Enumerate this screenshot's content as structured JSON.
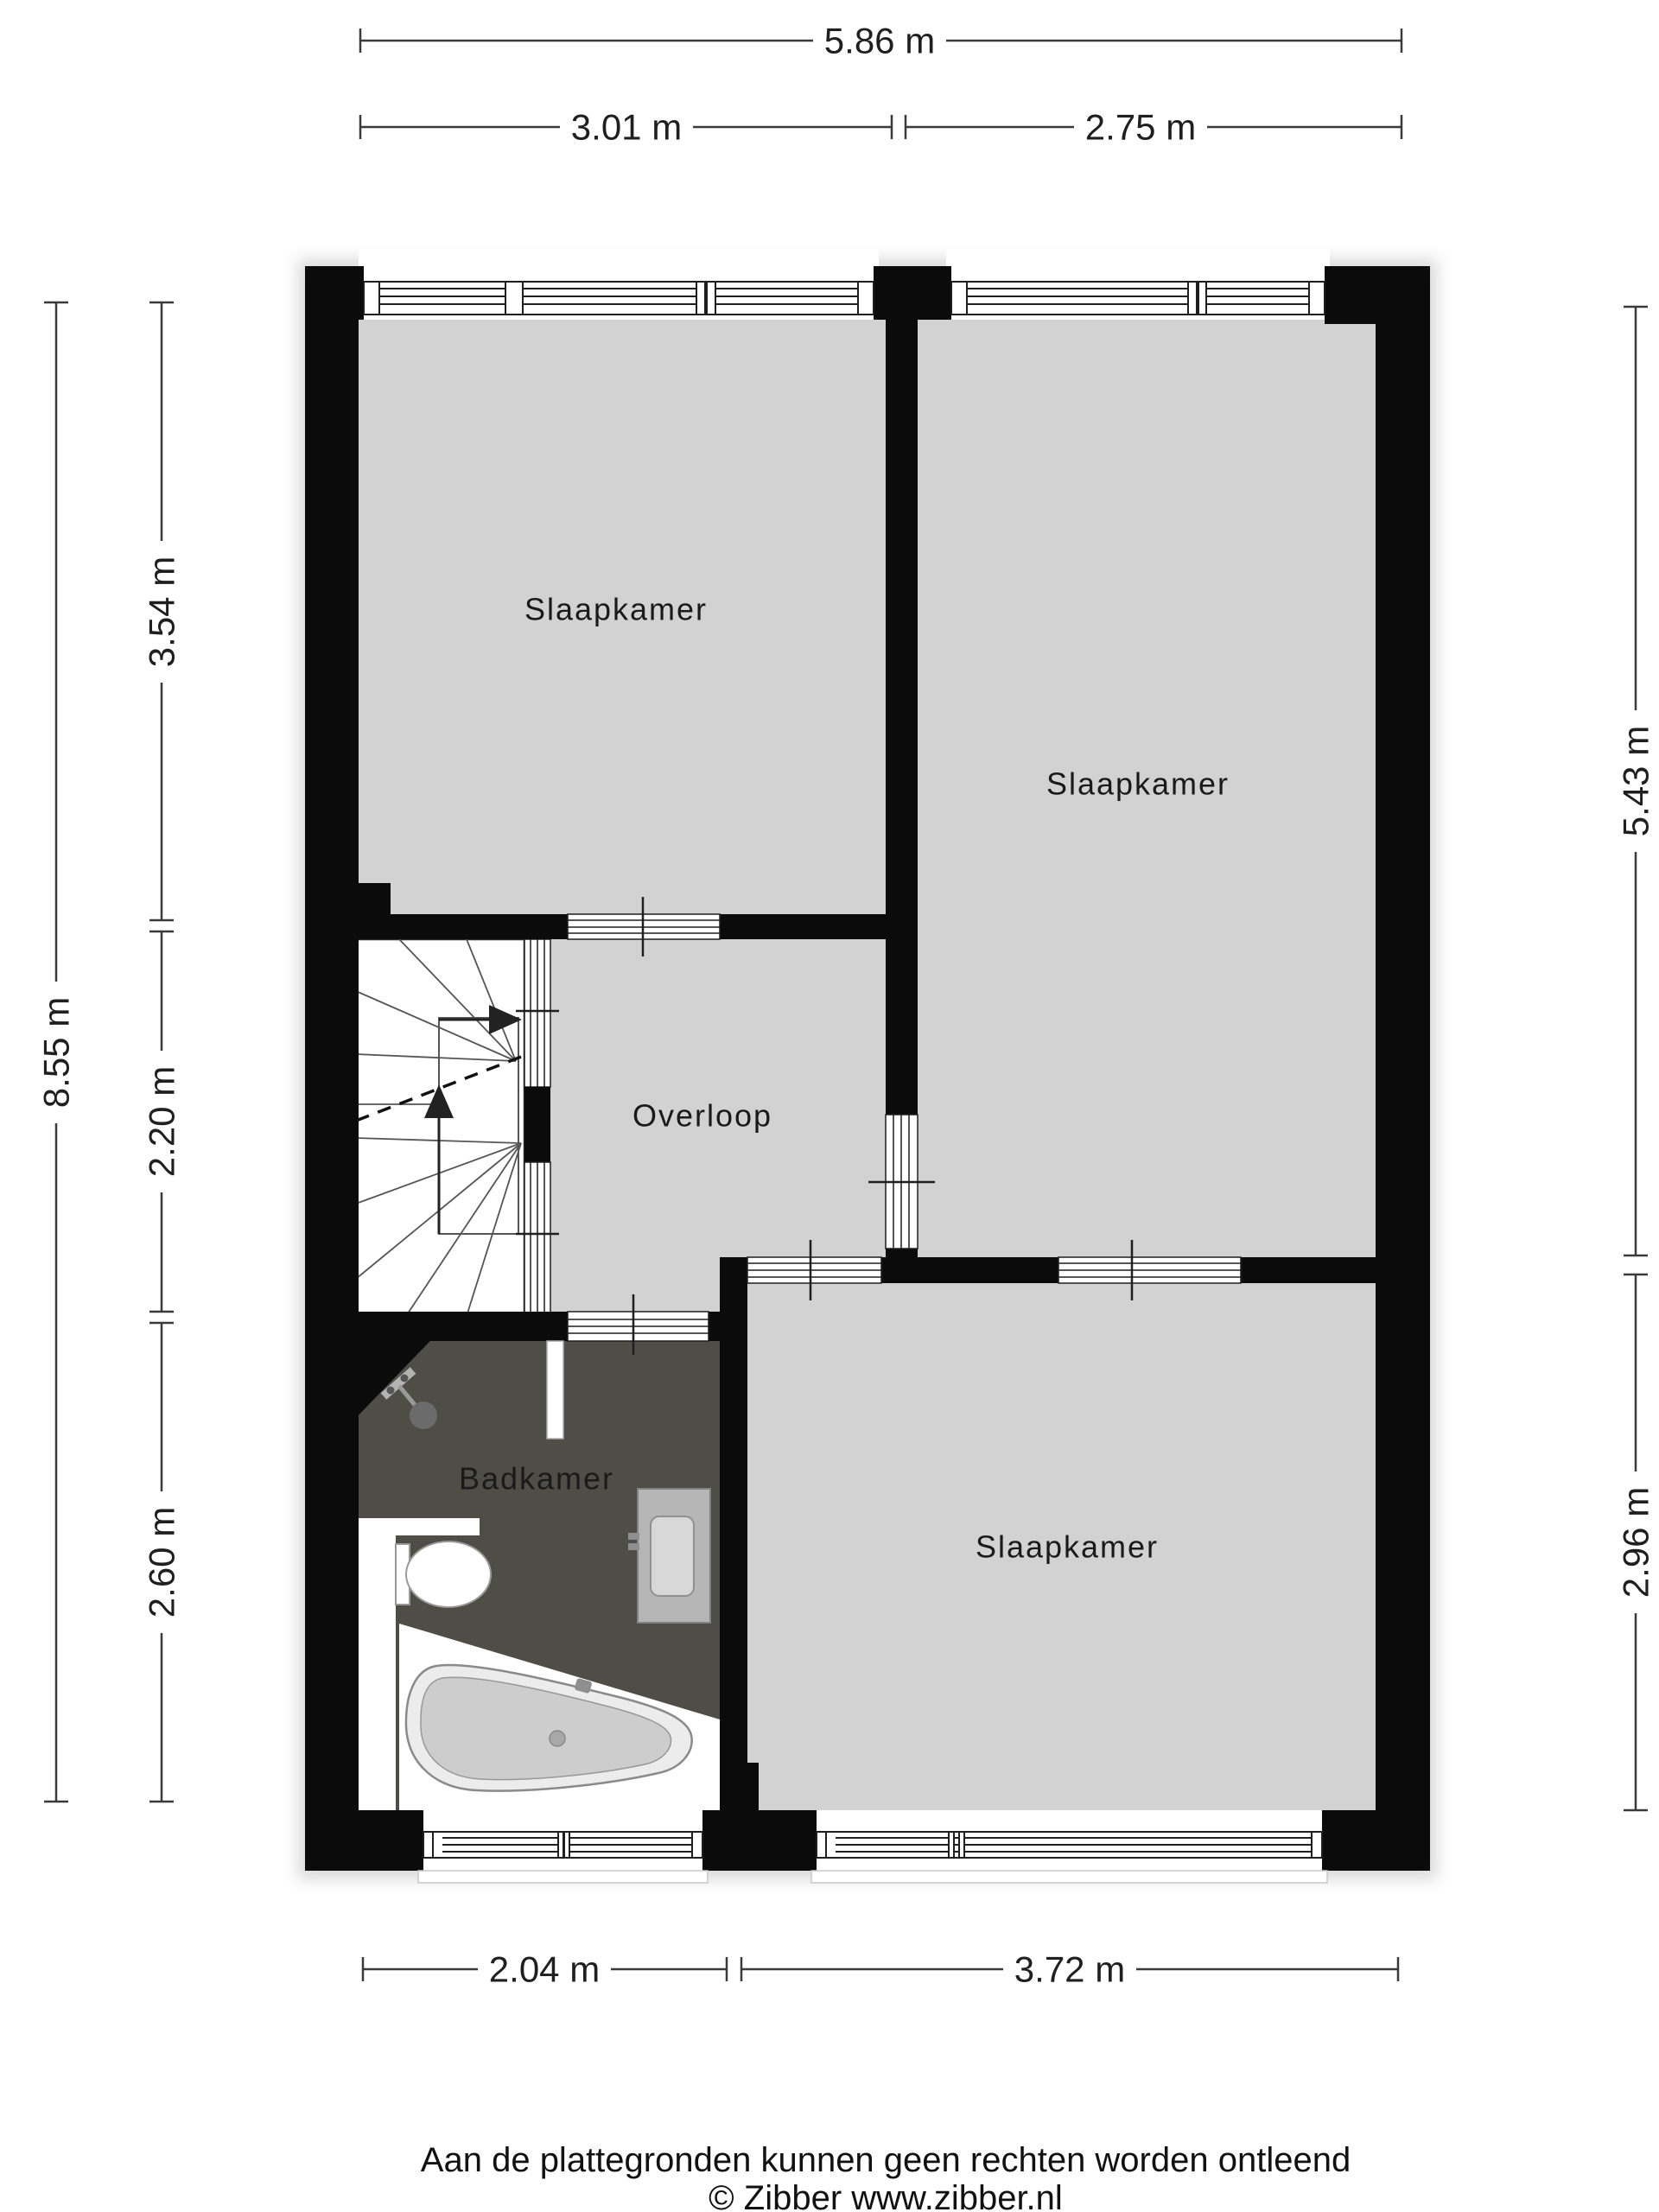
{
  "colors": {
    "wall": "#0b0b0b",
    "floor": "#d2d2d2",
    "bathroom_floor": "#4e4e47",
    "fixture_gray": "#b6b6b6"
  },
  "rooms": {
    "slaapkamer_top_left": "Slaapkamer",
    "slaapkamer_top_right": "Slaapkamer",
    "slaapkamer_bottom": "Slaapkamer",
    "overloop": "Overloop",
    "badkamer": "Badkamer"
  },
  "dimensions": {
    "top_total": "5.86 m",
    "top_left": "3.01 m",
    "top_right": "2.75 m",
    "left_total": "8.55 m",
    "left_upper": "3.54 m",
    "left_middle": "2.20 m",
    "left_lower": "2.60 m",
    "right_upper": "5.43 m",
    "right_lower": "2.96 m",
    "bottom_left": "2.04 m",
    "bottom_right": "3.72 m"
  },
  "footer": {
    "disclaimer": "Aan de plattegronden kunnen geen rechten worden ontleend",
    "copyright": "© Zibber www.zibber.nl"
  }
}
